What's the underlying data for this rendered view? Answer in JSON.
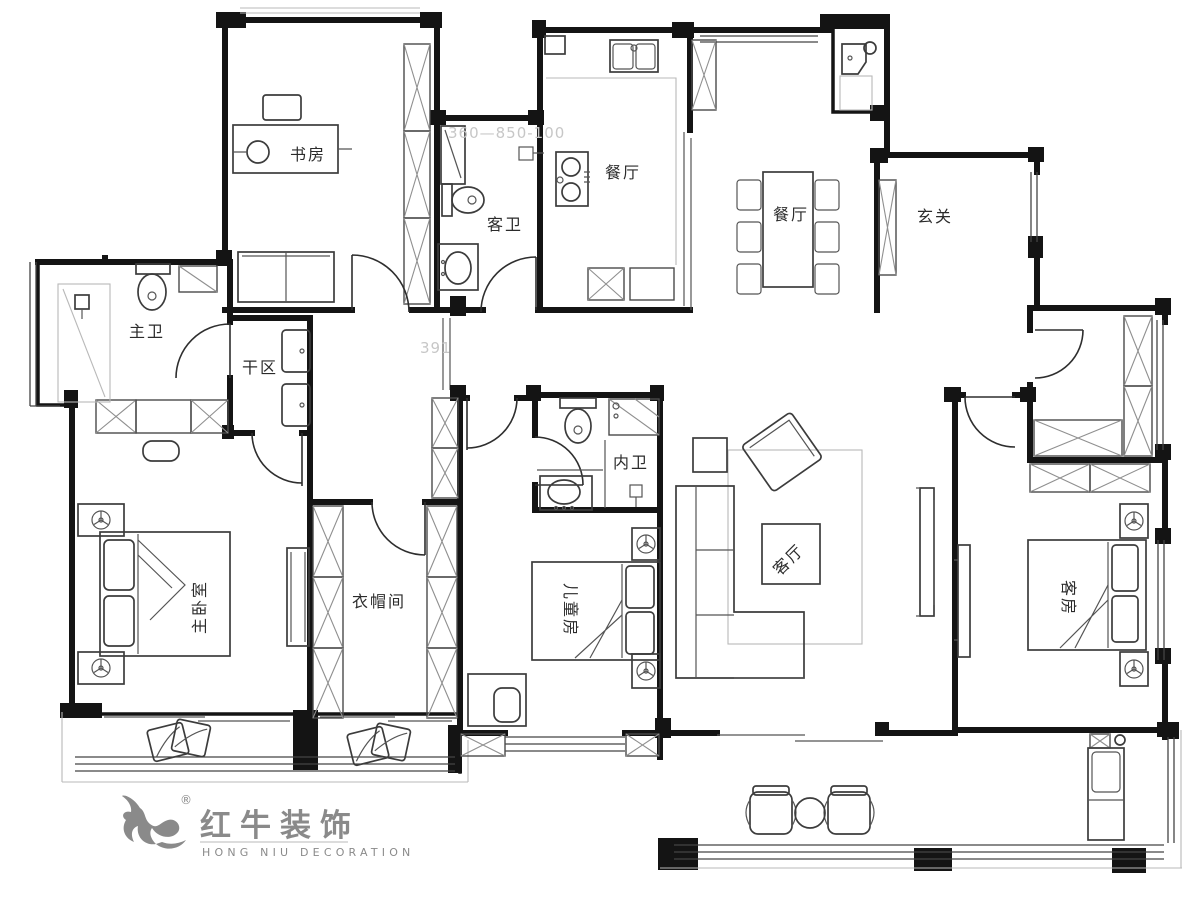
{
  "plan_title": "residential floor plan",
  "rooms": {
    "study": "书房",
    "guest_bath": "客卫",
    "kitchen": "餐厅",
    "dining": "餐厅",
    "entry": "玄关",
    "master_bath": "主卫",
    "dry_area": "干区",
    "master_bedroom": "主卧室",
    "cloakroom": "衣帽间",
    "kids_room": "儿童房",
    "inner_bath": "内卫",
    "living_room": "客厅",
    "guest_room": "客房"
  },
  "annotations": {
    "dim1": "360—850-100",
    "dim2": "391"
  },
  "logo": {
    "cn": "红牛装饰",
    "en": "HONG NIU DECORATION",
    "registered": "®",
    "color": "#8a8a8a"
  },
  "colors": {
    "wall": "#141414",
    "furniture": "#3c3c3c",
    "faint": "#c7c7c7",
    "logo_gray": "#8a8a8a"
  }
}
